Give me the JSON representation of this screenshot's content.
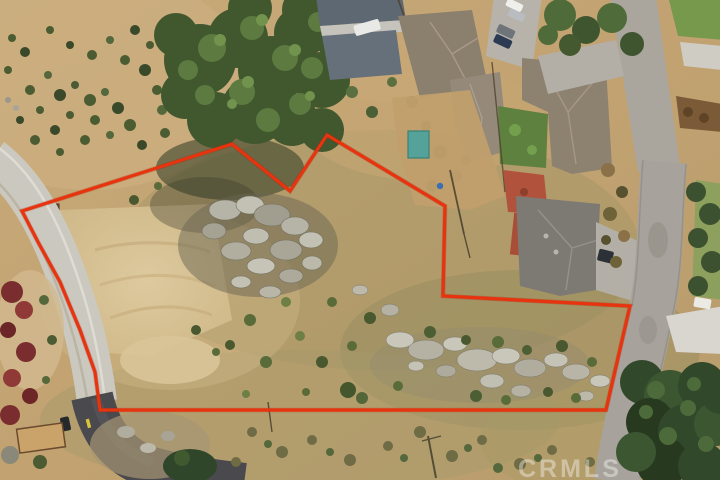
{
  "image": {
    "type": "aerial-drone-photo",
    "subject": "Vacant dirt land parcel outlined with a red property-boundary overlay; rock outcrops and scrub inside the lot, neighboring single-family homes and streets at top and right",
    "width": 720,
    "height": 480
  },
  "watermark": {
    "text": "CRMLS",
    "color": "#ffffff",
    "opacity": 0.38
  },
  "boundary": {
    "color": "#e8330f",
    "stroke_width": 3.2,
    "points": "22,211 232,144 290,191 327,135 445,206 443,296 630,306 606,410 100,410 95,372 80,330 60,282 38,242"
  },
  "palette": {
    "dirt": "#c2a271",
    "dirt_light": "#dac69b",
    "scrub_olive": "#8f8a5c",
    "tree_green": "#41582f",
    "tree_highlight": "#648447",
    "rock_gray": "#b6b4a7",
    "road_concrete": "#cbc8c0",
    "road_asphalt": "#46454a",
    "roof_taupe": "#8b7f6e",
    "roof_gray": "#7d7a73",
    "roof_blue_gray": "#5d6873",
    "patio_red": "#b0523c",
    "shed_teal": "#55a29a",
    "lawn_green": "#5f813f"
  }
}
